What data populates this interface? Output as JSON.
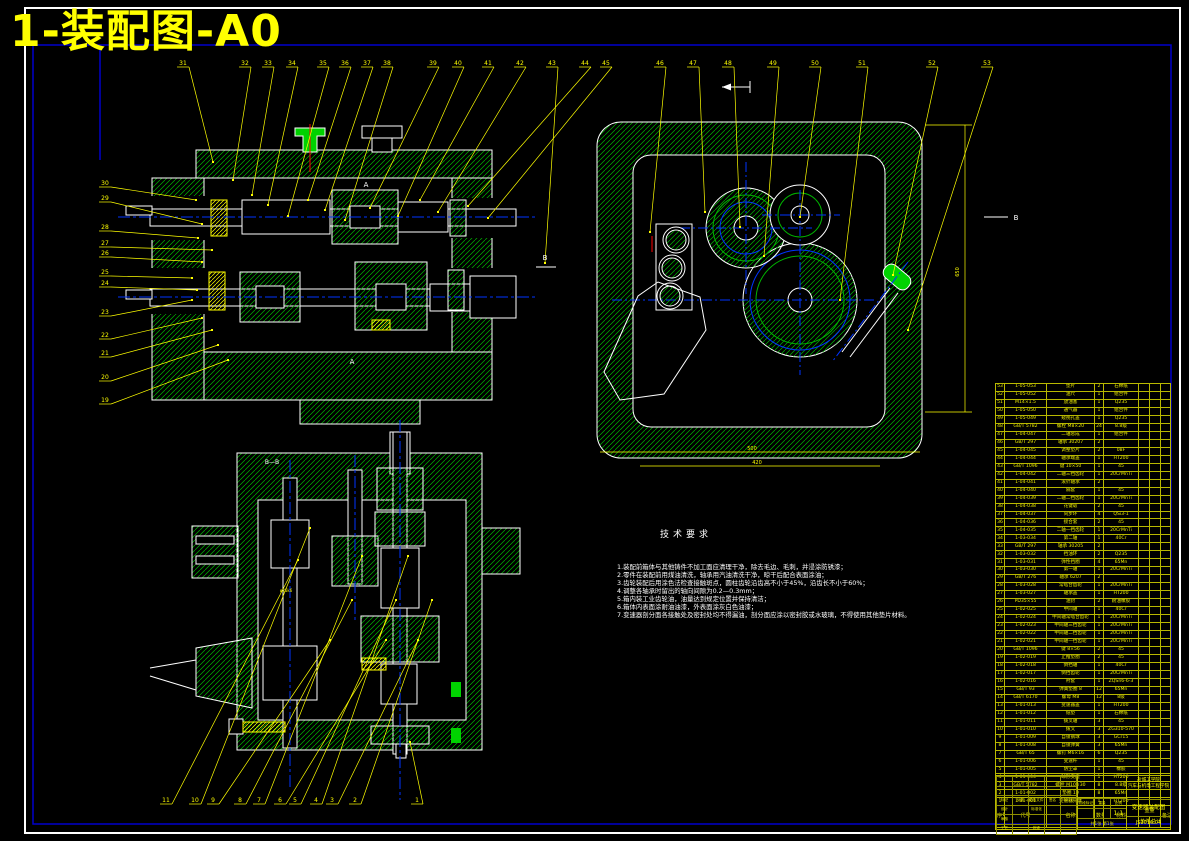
{
  "page": {
    "title": "1-装配图-A0",
    "colors": {
      "background": "#000000",
      "frame_outer": "#FFFFFF",
      "frame_inner": "#0000CC",
      "outline": "#FFFFFF",
      "hatch": "#00B400",
      "highlight_green": "#00D200",
      "leader": "#FFFF00",
      "centerline": "#0033FF",
      "bolt_center": "#FF0000",
      "title_text": "#FFFF00"
    }
  },
  "tech": {
    "title": "技术要求",
    "lines": [
      "1.装配前箱体与其他铸件不加工面应清理干净，除去毛边、毛刺，并浸涂防锈漆；",
      "2.零件在装配前用煤油清洗，轴承用汽油清洗干净，晾干后配合表面涂油；",
      "3.齿轮装配后用涂色法检查接触斑点，圆柱齿轮沿齿高不小于45%，沿齿长不小于60%；",
      "4.调整各轴承时留出的轴向间隙为0.2—0.3mm；",
      "5.箱内装工业齿轮油，油量达到规定位置并保持清洁；",
      "6.箱体内表面涂耐油油漆，外表面涂灰白色油漆；",
      "7.变速器剖分面各接触处及密封处均不得漏油，剖分面应涂以密封胶或水玻璃，不得使用其他垫片材料。"
    ]
  },
  "leaders": {
    "top": [
      [
        "31",
        183,
        60,
        213,
        162
      ],
      [
        "32",
        245,
        60,
        233,
        180
      ],
      [
        "33",
        268,
        60,
        252,
        195
      ],
      [
        "34",
        292,
        60,
        268,
        205
      ],
      [
        "35",
        323,
        60,
        288,
        216
      ],
      [
        "36",
        345,
        60,
        308,
        200
      ],
      [
        "37",
        367,
        60,
        325,
        210
      ],
      [
        "38",
        387,
        60,
        345,
        220
      ],
      [
        "39",
        433,
        60,
        370,
        208
      ],
      [
        "40",
        458,
        60,
        398,
        216
      ],
      [
        "41",
        488,
        60,
        420,
        200
      ],
      [
        "42",
        520,
        60,
        438,
        212
      ],
      [
        "43",
        552,
        60,
        545,
        263
      ],
      [
        "44",
        585,
        60,
        468,
        206
      ],
      [
        "45",
        606,
        60,
        488,
        218
      ],
      [
        "46",
        660,
        60,
        650,
        232
      ],
      [
        "47",
        693,
        60,
        705,
        212
      ],
      [
        "48",
        728,
        60,
        740,
        227
      ],
      [
        "49",
        773,
        60,
        764,
        256
      ],
      [
        "50",
        815,
        60,
        800,
        217
      ],
      [
        "51",
        862,
        60,
        840,
        300
      ],
      [
        "52",
        932,
        60,
        893,
        275
      ],
      [
        "53",
        987,
        60,
        908,
        330
      ]
    ],
    "left": [
      [
        "30",
        105,
        180,
        196,
        200
      ],
      [
        "29",
        105,
        195,
        202,
        224
      ],
      [
        "28",
        105,
        224,
        198,
        238
      ],
      [
        "27",
        105,
        240,
        212,
        250
      ],
      [
        "26",
        105,
        250,
        202,
        262
      ],
      [
        "25",
        105,
        269,
        192,
        278
      ],
      [
        "24",
        105,
        280,
        197,
        290
      ],
      [
        "23",
        105,
        309,
        192,
        300
      ],
      [
        "22",
        105,
        332,
        202,
        318
      ],
      [
        "21",
        105,
        350,
        212,
        330
      ],
      [
        "20",
        105,
        374,
        218,
        345
      ],
      [
        "19",
        105,
        397,
        228,
        360
      ]
    ],
    "bottom": [
      [
        "11",
        166,
        797,
        298,
        560
      ],
      [
        "10",
        195,
        797,
        310,
        528
      ],
      [
        "9",
        213,
        797,
        330,
        640
      ],
      [
        "8",
        240,
        797,
        352,
        600
      ],
      [
        "7",
        259,
        797,
        362,
        556
      ],
      [
        "6",
        280,
        797,
        386,
        640
      ],
      [
        "5",
        295,
        797,
        396,
        600
      ],
      [
        "4",
        316,
        797,
        408,
        556
      ],
      [
        "3",
        332,
        797,
        418,
        640
      ],
      [
        "2",
        355,
        797,
        432,
        600
      ],
      [
        "1",
        417,
        797,
        410,
        742
      ]
    ]
  },
  "annotations": [
    {
      "t": "A",
      "x": 366,
      "y": 187,
      "c": "#FFFFFF",
      "s": 7
    },
    {
      "t": "A",
      "x": 352,
      "y": 364,
      "c": "#FFFFFF",
      "s": 7
    },
    {
      "t": "B—B",
      "x": 272,
      "y": 464,
      "c": "#FFFFFF",
      "s": 6
    },
    {
      "t": "B",
      "x": 545,
      "y": 260,
      "c": "#FFFFFF",
      "s": 7
    },
    {
      "t": "B",
      "x": 1016,
      "y": 220,
      "c": "#FFFFFF",
      "s": 7
    },
    {
      "t": "650",
      "x": 959,
      "y": 272,
      "c": "#FFFF00",
      "s": 5,
      "r": -90
    },
    {
      "t": "500",
      "x": 752,
      "y": 450,
      "c": "#FFFF00",
      "s": 5
    },
    {
      "t": "420",
      "x": 757,
      "y": 464,
      "c": "#FFFF00",
      "s": 5
    },
    {
      "t": "φ25k6",
      "x": 286,
      "y": 592,
      "c": "#FFFF00",
      "s": 4
    }
  ],
  "parts_table": {
    "header": {
      "cols": [
        "序号",
        "代号",
        "名称",
        "数量",
        "材料",
        "备注"
      ],
      "weight": "重量",
      "weight_sub": [
        "单件",
        "总计"
      ]
    },
    "rows": [
      [
        "53",
        "1-05-053",
        "垫片",
        "2",
        "石棉纸"
      ],
      [
        "52",
        "1-05-052",
        "油尺",
        "1",
        "组合件"
      ],
      [
        "51",
        "M14×1.5",
        "放油塞",
        "1",
        "Q235"
      ],
      [
        "50",
        "1-05-050",
        "通气器",
        "1",
        "组合件"
      ],
      [
        "49",
        "1-05-049",
        "窥视孔盖",
        "1",
        "Q235"
      ],
      [
        "48",
        "GB/T 5782",
        "螺栓 M8×20",
        "24",
        "8.8级"
      ],
      [
        "47",
        "1-04-047",
        "二轴总成",
        "1",
        "组合件"
      ],
      [
        "46",
        "GB/T 297",
        "轴承 30207",
        "2",
        ""
      ],
      [
        "45",
        "1-04-045",
        "调整垫片",
        "2",
        "08F"
      ],
      [
        "44",
        "1-04-044",
        "轴承端盖",
        "1",
        "HT200"
      ],
      [
        "43",
        "GB/T 1096",
        "键 10×50",
        "1",
        "45"
      ],
      [
        "42",
        "1-04-042",
        "二轴三挡齿轮",
        "1",
        "20CrMnTi"
      ],
      [
        "41",
        "1-04-041",
        "滚针轴承",
        "2",
        ""
      ],
      [
        "40",
        "1-04-040",
        "隔套",
        "1",
        "45"
      ],
      [
        "39",
        "1-04-039",
        "二轴二挡齿轮",
        "1",
        "20CrMnTi"
      ],
      [
        "38",
        "1-04-038",
        "花键毂",
        "2",
        "45"
      ],
      [
        "37",
        "1-04-037",
        "同步环",
        "4",
        "QSi3-1"
      ],
      [
        "36",
        "1-04-036",
        "接合套",
        "2",
        "45"
      ],
      [
        "35",
        "1-04-035",
        "二轴一挡齿轮",
        "1",
        "20CrMnTi"
      ],
      [
        "34",
        "1-03-034",
        "第二轴",
        "1",
        "40Cr"
      ],
      [
        "33",
        "GB/T 297",
        "轴承 30205",
        "2",
        ""
      ],
      [
        "32",
        "1-03-032",
        "挡油环",
        "2",
        "Q235"
      ],
      [
        "31",
        "1-03-031",
        "弹性挡圈",
        "4",
        "65Mn"
      ],
      [
        "30",
        "1-03-030",
        "第一轴",
        "1",
        "20CrMnTi"
      ],
      [
        "29",
        "GB/T 276",
        "轴承 6207",
        "2",
        ""
      ],
      [
        "28",
        "1-03-028",
        "常啮合齿轮",
        "1",
        "20CrMnTi"
      ],
      [
        "27",
        "1-03-027",
        "轴承盖",
        "1",
        "HT200"
      ],
      [
        "26",
        "PD35×55",
        "油封",
        "2",
        "耐油橡胶"
      ],
      [
        "25",
        "1-02-025",
        "中间轴",
        "1",
        "40Cr"
      ],
      [
        "24",
        "1-02-024",
        "中间轴常啮合齿轮",
        "1",
        "20CrMnTi"
      ],
      [
        "23",
        "1-02-023",
        "中间轴三挡齿轮",
        "1",
        "20CrMnTi"
      ],
      [
        "22",
        "1-02-022",
        "中间轴二挡齿轮",
        "1",
        "20CrMnTi"
      ],
      [
        "21",
        "1-02-021",
        "中间轴一挡齿轮",
        "1",
        "20CrMnTi"
      ],
      [
        "20",
        "GB/T 1096",
        "键 8×56",
        "2",
        "45"
      ],
      [
        "19",
        "1-02-019",
        "止推垫圈",
        "2",
        "45"
      ],
      [
        "18",
        "1-02-018",
        "倒挡轴",
        "1",
        "40Cr"
      ],
      [
        "17",
        "1-02-017",
        "倒挡齿轮",
        "1",
        "20CrMnTi"
      ],
      [
        "16",
        "1-02-016",
        "衬套",
        "1",
        "ZQSn6-6-3"
      ],
      [
        "15",
        "GB/T 93",
        "弹簧垫圈 8",
        "12",
        "65Mn"
      ],
      [
        "14",
        "GB/T 6170",
        "螺母 M8",
        "12",
        "8级"
      ],
      [
        "13",
        "1-01-013",
        "变速器盖",
        "1",
        "HT200"
      ],
      [
        "12",
        "1-01-012",
        "纸垫",
        "1",
        "石棉纸"
      ],
      [
        "11",
        "1-01-011",
        "拨叉轴",
        "3",
        "45"
      ],
      [
        "10",
        "1-01-010",
        "拨叉",
        "3",
        "ZG310-570"
      ],
      [
        "9",
        "1-01-009",
        "自锁钢球",
        "3",
        "GCr15"
      ],
      [
        "8",
        "1-01-008",
        "自锁弹簧",
        "3",
        "65Mn"
      ],
      [
        "7",
        "GB/T 65",
        "螺钉 M6×16",
        "6",
        "Q235"
      ],
      [
        "6",
        "1-01-006",
        "变速杆",
        "1",
        "45"
      ],
      [
        "5",
        "1-01-005",
        "防尘罩",
        "1",
        "橡胶"
      ],
      [
        "4",
        "1-01-004",
        "球形支座",
        "1",
        "HT200"
      ],
      [
        "3",
        "GB/T 5782",
        "螺栓 M10×30",
        "8",
        "8.8级"
      ],
      [
        "2",
        "1-01-002",
        "垫圈 10",
        "8",
        "65Mn"
      ],
      [
        "1",
        "1-01-001",
        "变速器壳体",
        "1",
        "HT200"
      ]
    ]
  },
  "title_block": {
    "left_rows": [
      [
        "",
        "",
        "",
        "",
        ""
      ],
      [
        "",
        "",
        "",
        "",
        ""
      ],
      [
        "标记",
        "处数",
        "更改文件号",
        "签名",
        "年月日"
      ],
      [
        "设计",
        "",
        "标准化",
        "",
        ""
      ],
      [
        "审核",
        "",
        "",
        "",
        ""
      ],
      [
        "工艺",
        "",
        "批准",
        "",
        ""
      ]
    ],
    "stage_label": "阶段标记",
    "weight_label": "重量",
    "scale_label": "比例",
    "scale_value": "1:1",
    "sheet_text": "共1张 第1张",
    "school_line1": "盐城工学院",
    "school_line2": "汽车与机电工程学院",
    "drawing_name": "变速器装配图",
    "drawing_code": "JS2016.04"
  }
}
